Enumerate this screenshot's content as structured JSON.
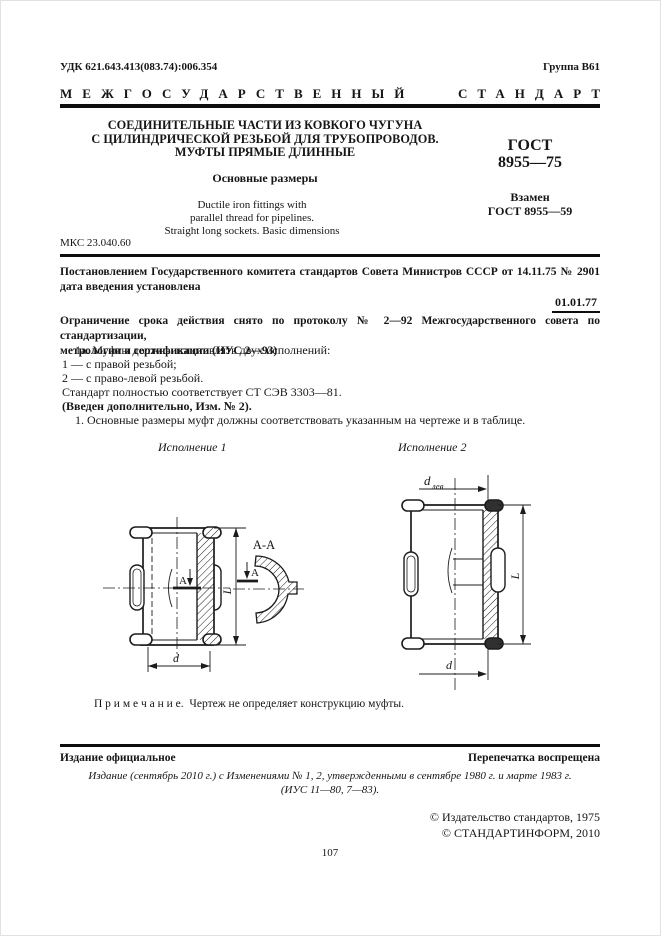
{
  "colors": {
    "paper": "#ffffff",
    "ink": "#161616",
    "rule": "#0d0d0d"
  },
  "header": {
    "udk": "УДК 621.643.413(083.74):006.354",
    "group": "Группа В61",
    "banner_word1": "МЕЖГОСУДАРСТВЕННЫЙ",
    "banner_word2": "СТАНДАРТ"
  },
  "title_block": {
    "title_lines": [
      "СОЕДИНИТЕЛЬНЫЕ ЧАСТИ ИЗ КОВКОГО ЧУГУНА",
      "С ЦИЛИНДРИЧЕСКОЙ РЕЗЬБОЙ ДЛЯ ТРУБОПРОВОДОВ.",
      "МУФТЫ ПРЯМЫЕ ДЛИННЫЕ"
    ],
    "subtitle": "Основные размеры",
    "english_lines": [
      "Ductile iron fittings with",
      "parallel thread for  pipelines.",
      "Straight long sockets. Basic dimensions"
    ],
    "gost_label": "ГОСТ",
    "gost_number": "8955—75",
    "replaces_label": "Взамен",
    "replaces_number": "ГОСТ 8955—59"
  },
  "mks": "МКС 23.040.60",
  "decree": {
    "line1": "Постановлением   Государственного   комитета   стандартов   Совета   Министров   СССР   от 14.11.75 № 2901",
    "line2": "дата введения установлена",
    "effective_date": "01.01.77"
  },
  "restriction": {
    "line1": "Ограничение срока действия снято по протоколу № 2—92 Межгосударственного совета по стандартизации,",
    "line2": "метрологии и сертификации (ИУС 2—93)"
  },
  "body": {
    "items": [
      "1а. Муфты должны изготовлять двух исполнений:",
      "1 — с правой резьбой;",
      "2 — с право-левой резьбой.",
      "Стандарт полностью соответствует СТ СЭВ 3303—81.",
      "(Введен дополнительно, Изм. № 2).",
      "1. Основные размеры муфт должны соответствовать указанным на чертеже и в таблице."
    ]
  },
  "drawing": {
    "variant1_label": "Исполнение 1",
    "variant2_label": "Исполнение 2",
    "section_view_label": "А-А",
    "section_marker": "А",
    "dim_length": "L",
    "dim_diameter": "d",
    "dim_left_base": "d",
    "dim_left_sub": "лев"
  },
  "note": {
    "label": "П р и м е ч а н и е.",
    "text": "Чертеж не определяет конструкцию муфты."
  },
  "footer": {
    "official": "Издание  официальное",
    "reprint": "Перепечатка воспрещена",
    "edition_line1": "Издание (сентябрь 2010 г.) с Изменениями № 1, 2, утвержденными в сентябре 1980 г. и марте 1983 г.",
    "edition_line2": "(ИУС 11—80, 7—83).",
    "copyright1": "© Издательство стандартов, 1975",
    "copyright2": "© СТАНДАРТИНФОРМ, 2010",
    "page_number": "107"
  }
}
